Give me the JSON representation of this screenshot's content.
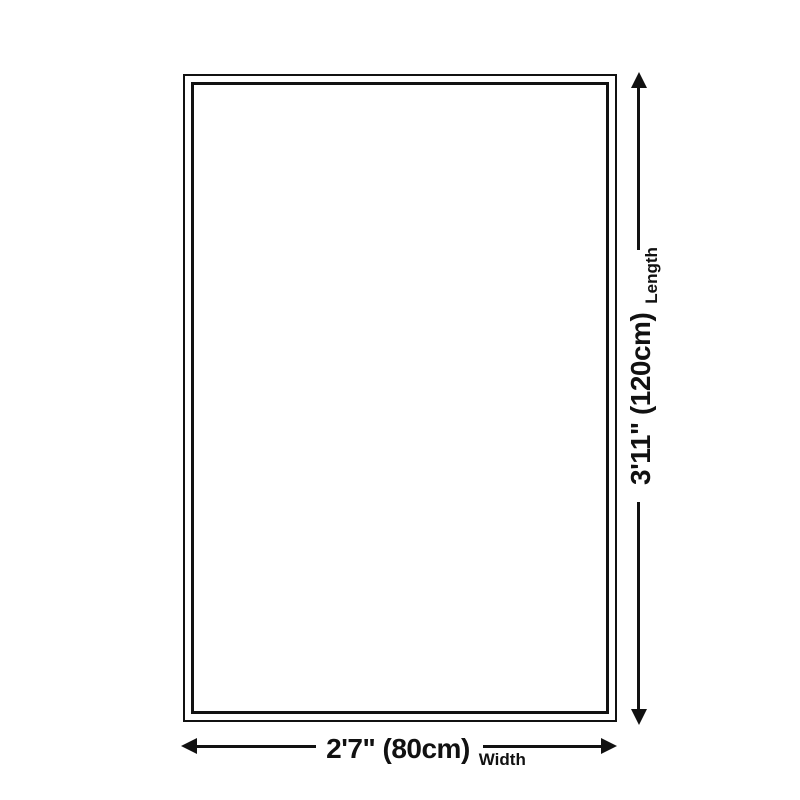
{
  "diagram": {
    "length": {
      "value": "3'11\" (120cm)",
      "axis": "Length"
    },
    "width": {
      "value": "2'7\" (80cm)",
      "axis": "Width"
    },
    "icons": {
      "vertical_arrows": "up-arrow-icon / down-arrow-icon",
      "horizontal_arrows": "left-arrow-icon / right-arrow-icon"
    },
    "colors": {
      "line": "#111111",
      "text": "#111111",
      "background": "#ffffff"
    }
  }
}
